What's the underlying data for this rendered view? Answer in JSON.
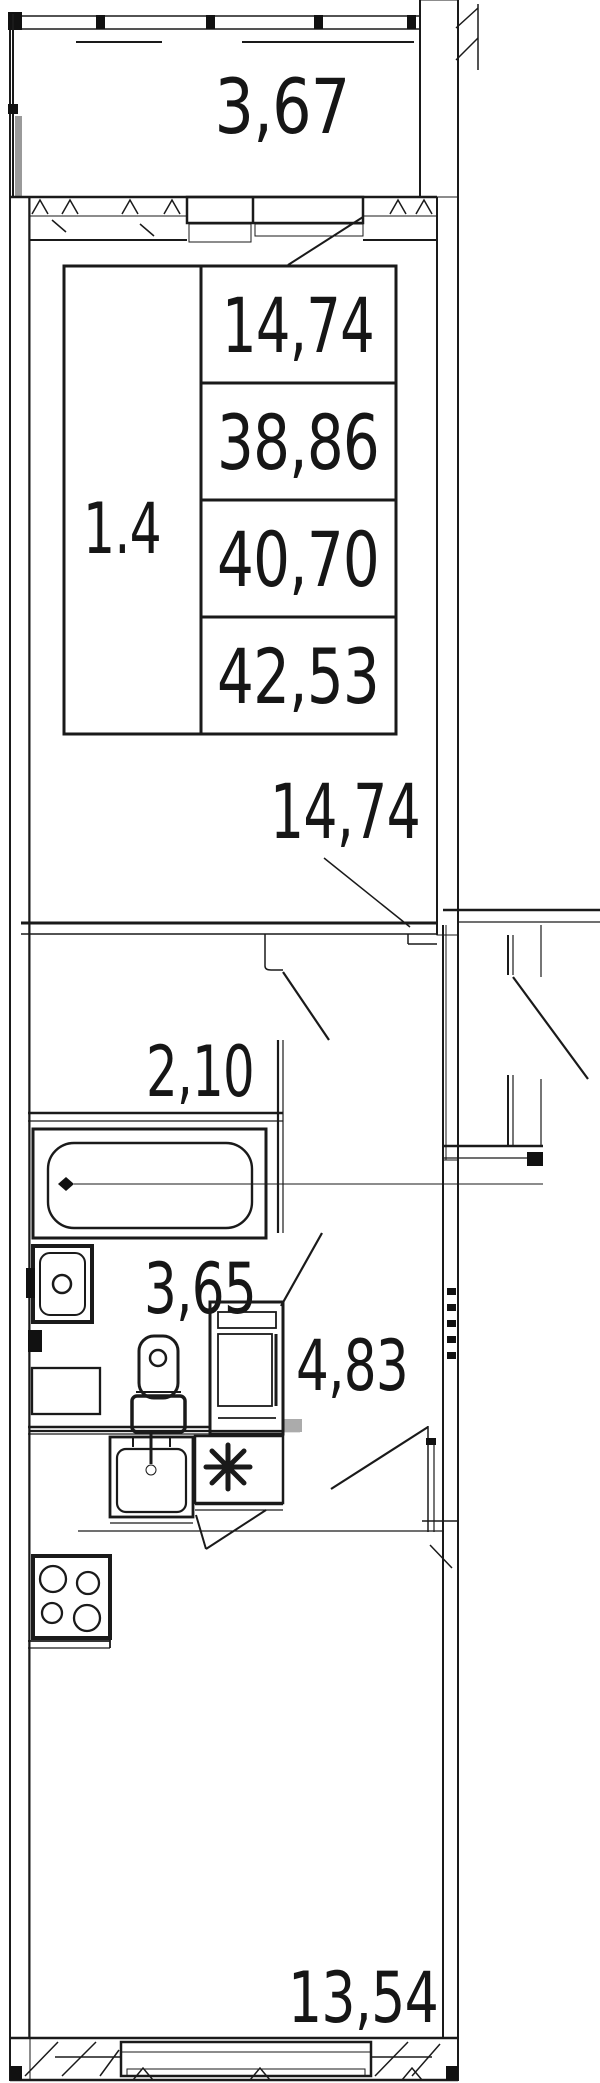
{
  "page": {
    "title": "Apartment floor plan"
  },
  "stamp": {
    "apartment_no": "1.4",
    "areas": [
      "14,74",
      "38,86",
      "40,70",
      "42,53"
    ]
  },
  "rooms": {
    "balcony": {
      "area": "3,67"
    },
    "living_room": {
      "area": "14,74"
    },
    "storage": {
      "area": "2,10"
    },
    "bathroom": {
      "area": "3,65"
    },
    "hallway": {
      "area": "4,83"
    },
    "kitchen_living": {
      "area": "13,54"
    }
  },
  "colors": {
    "line": "#1a1a1a",
    "glazing": "#ababab",
    "sill": "#b3b3b3"
  }
}
